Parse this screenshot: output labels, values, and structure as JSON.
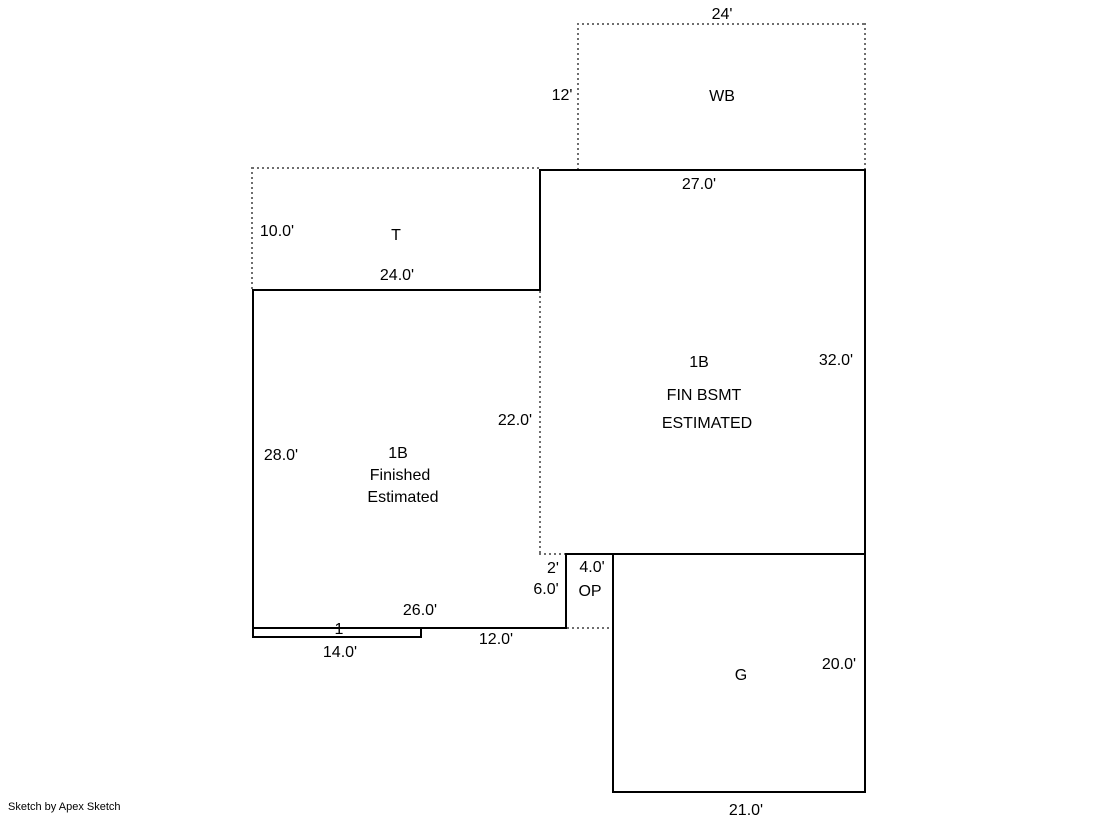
{
  "colors": {
    "background": "#ffffff",
    "solid_line": "#000000",
    "dotted_line": "#6e6e6e",
    "text": "#000000"
  },
  "areas": {
    "wb": {
      "name": "WB",
      "width_label": "24'",
      "height_label": "12'"
    },
    "t": {
      "name": "T",
      "width_label": "24.0'",
      "height_label": "10.0'"
    },
    "bsmt": {
      "name_lines": [
        "1B",
        "FIN BSMT",
        "ESTIMATED"
      ],
      "width_label": "27.0'",
      "height_label": "32.0'"
    },
    "finished": {
      "name_lines": [
        "1B",
        "Finished",
        "Estimated"
      ],
      "height_label": "28.0'",
      "right_label": "22.0'",
      "bottom_label": "26.0'",
      "bottom_right_label": "12.0'"
    },
    "op": {
      "name": "OP",
      "jog_label": "2'",
      "width_label": "4.0'",
      "height_label": "6.0'"
    },
    "stoop": {
      "height_label": "1",
      "width_label": "14.0'"
    },
    "g": {
      "name": "G",
      "width_label": "21.0'",
      "height_label": "20.0'"
    }
  },
  "footer": {
    "credit": "Sketch by Apex Sketch"
  }
}
